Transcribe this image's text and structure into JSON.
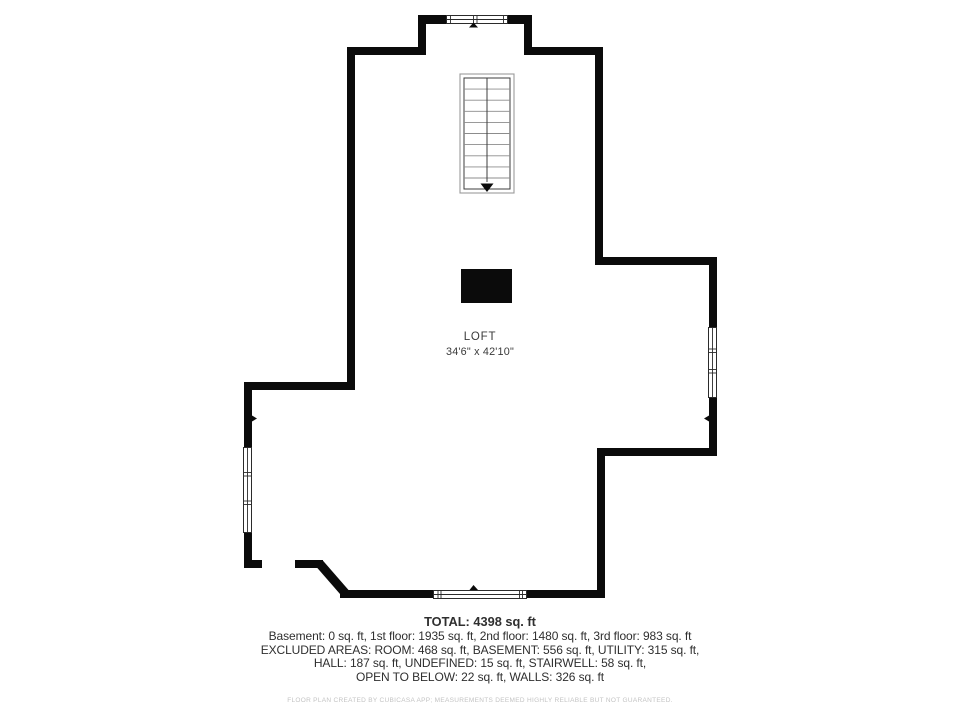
{
  "plan": {
    "room_label": "LOFT",
    "room_dimensions": "34'6\" x 42'10\""
  },
  "summary": {
    "total": "TOTAL: 4398 sq. ft",
    "lines": [
      "Basement: 0 sq. ft, 1st floor: 1935 sq. ft, 2nd floor: 1480 sq. ft, 3rd floor: 983 sq. ft",
      "EXCLUDED AREAS: ROOM: 468 sq. ft, BASEMENT: 556 sq. ft, UTILITY: 315 sq. ft,",
      "HALL: 187 sq. ft, UNDEFINED: 15 sq. ft, STAIRWELL: 58 sq. ft,",
      "OPEN TO BELOW: 22 sq. ft, WALLS: 326 sq. ft"
    ],
    "disclaimer": "FLOOR PLAN CREATED BY CUBICASA APP; MEASUREMENTS DEEMED HIGHLY RELIABLE BUT NOT GUARANTEED."
  },
  "icons": {
    "stair_arrow": "triangle-down",
    "window_marker": "triangle-up",
    "wall_marker": "small-triangle"
  },
  "colors": {
    "background": "#ffffff",
    "wall": "#0b0b0b",
    "window_frame": "#2b2b2b",
    "stair_outline": "#9a9a9a",
    "stair_detail": "#3c3c3c",
    "tread": "#8c8c8c",
    "label": "#3a3a3a",
    "text": "#2f2f2f",
    "disclaimer": "#c3c3c3"
  }
}
